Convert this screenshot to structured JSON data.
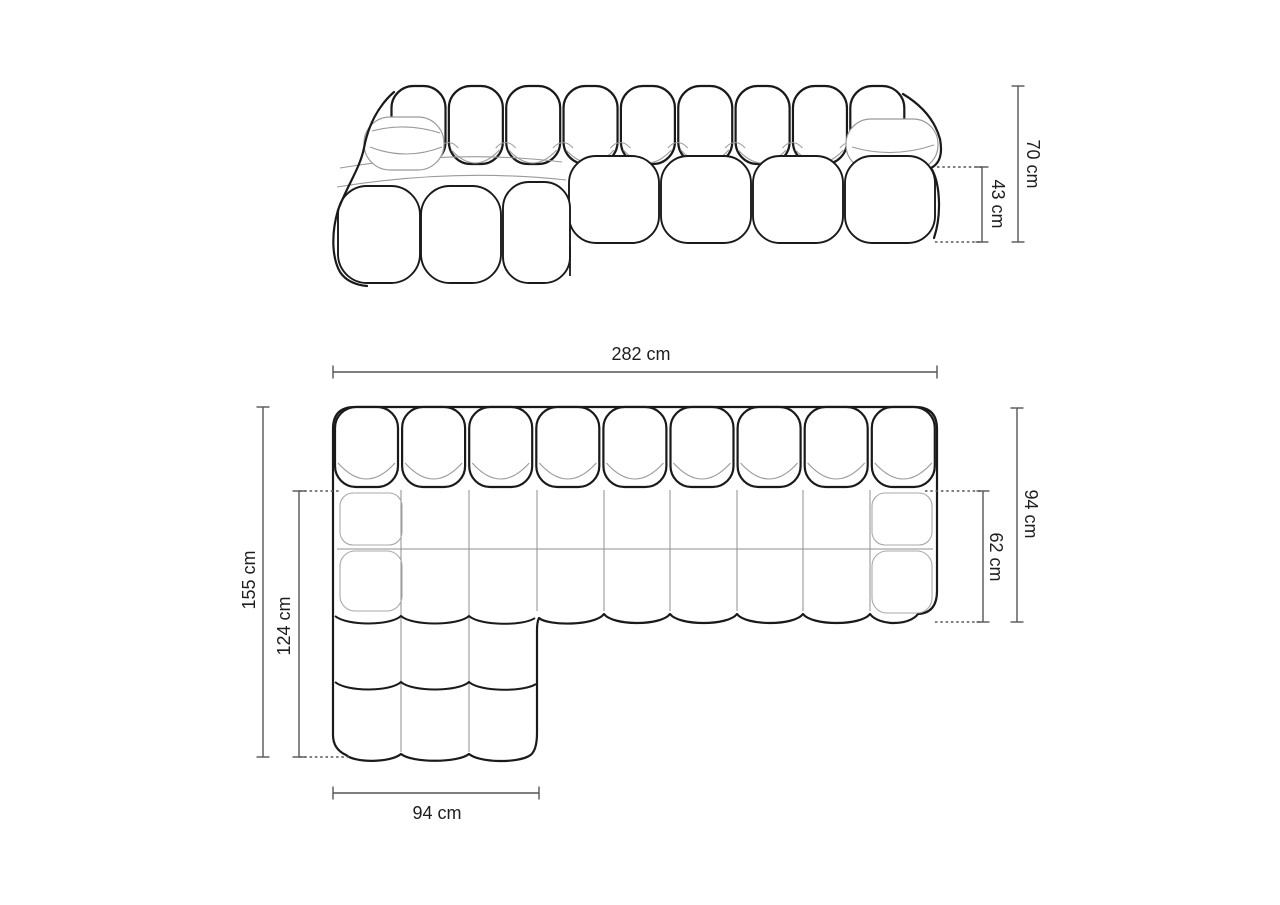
{
  "diagram": {
    "kind": "sofa-dimension-drawing",
    "views": {
      "front": {
        "dimensions": {
          "total_height": {
            "label": "70 cm",
            "value": 70,
            "unit": "cm"
          },
          "seat_height": {
            "label": "43 cm",
            "value": 43,
            "unit": "cm"
          }
        }
      },
      "top": {
        "dimensions": {
          "total_width": {
            "label": "282 cm",
            "value": 282,
            "unit": "cm"
          },
          "total_depth": {
            "label": "155 cm",
            "value": 155,
            "unit": "cm"
          },
          "chaise_inner_depth": {
            "label": "124 cm",
            "value": 124,
            "unit": "cm"
          },
          "body_depth": {
            "label": "94 cm",
            "value": 94,
            "unit": "cm"
          },
          "seat_depth": {
            "label": "62 cm",
            "value": 62,
            "unit": "cm"
          },
          "chaise_width": {
            "label": "94 cm",
            "value": 94,
            "unit": "cm"
          }
        }
      }
    },
    "colors": {
      "background": "#ffffff",
      "outline": "#1a1a1a",
      "soft_line": "#9a9a9a",
      "dimension_line": "#555555",
      "text": "#1e1e1e"
    }
  }
}
